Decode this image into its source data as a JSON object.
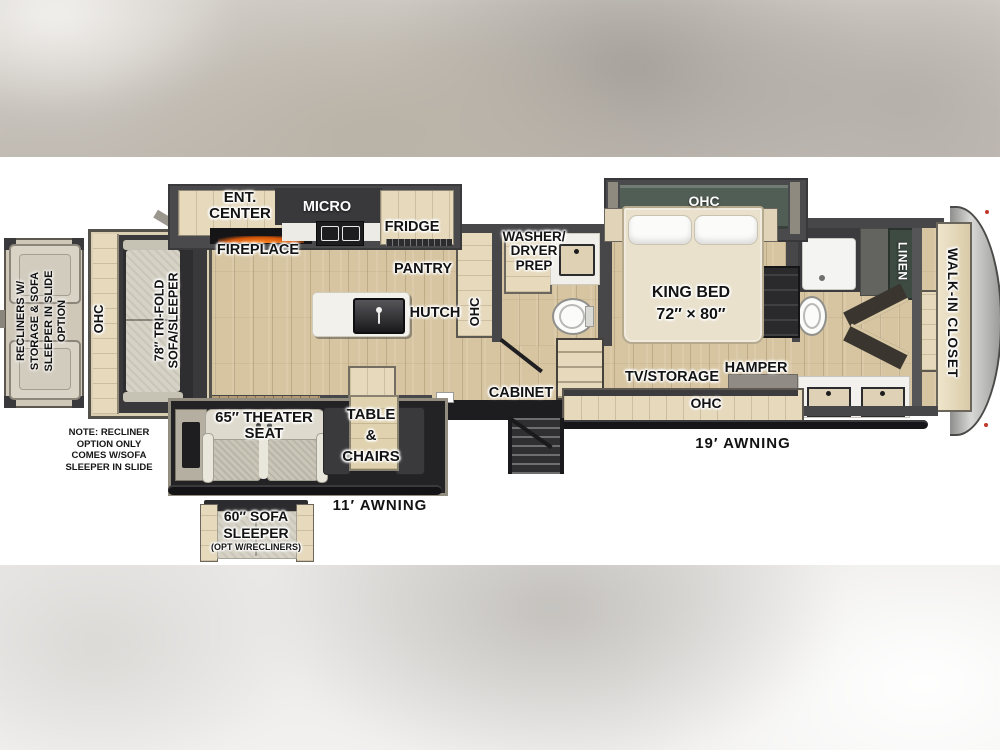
{
  "title": "Fifth-wheel RV floor plan",
  "option_box": {
    "lines": [
      "RECLINERS W/",
      "STORAGE & SOFA",
      "SLEEPER IN SLIDE",
      "OPTION"
    ]
  },
  "note": {
    "lines": [
      "NOTE: RECLINER",
      "OPTION ONLY",
      "COMES W/SOFA",
      "SLEEPER IN SLIDE"
    ]
  },
  "labels": {
    "ohc_slide": "OHC",
    "trifold_sofa": [
      "78″ TRI-FOLD",
      "SOFA/SLEEPER"
    ],
    "ent_center": [
      "ENT.",
      "CENTER"
    ],
    "fireplace": "FIREPLACE",
    "micro": "MICRO",
    "fridge": "FRIDGE",
    "pantry": "PANTRY",
    "hutch": "HUTCH",
    "ohc_kitchen": "OHC",
    "washer_dryer": [
      "WASHER/",
      "DRYER",
      "PREP"
    ],
    "cabinet": "CABINET",
    "king_bed": [
      "KING BED",
      "72″ × 80″"
    ],
    "ohc_bedroom": "OHC",
    "tv_storage": "TV/STORAGE",
    "hamper": "HAMPER",
    "ohc_console": "OHC",
    "awning_19": "19′ AWNING",
    "linen": "LINEN",
    "walk_in_closet": "WALK-IN CLOSET",
    "theater_seat": [
      "65″ THEATER",
      "SEAT"
    ],
    "table_chairs": [
      "TABLE",
      "&",
      "CHAIRS"
    ],
    "awning_11": "11′ AWNING",
    "sofa_option": [
      "60″ SOFA",
      "SLEEPER",
      "(OPT W/RECLINERS)"
    ]
  },
  "colors": {
    "floor_wood": "#d7c5a1",
    "cabinet_wood": "#e6d9bc",
    "wall_dark": "#47474a",
    "bedroom_ohc_green": "#515e55",
    "linen_green": "#3e4b43",
    "awning_black": "#161618",
    "fireplace_glow": "#e05a10",
    "marker_light_red": "#c0392b"
  }
}
